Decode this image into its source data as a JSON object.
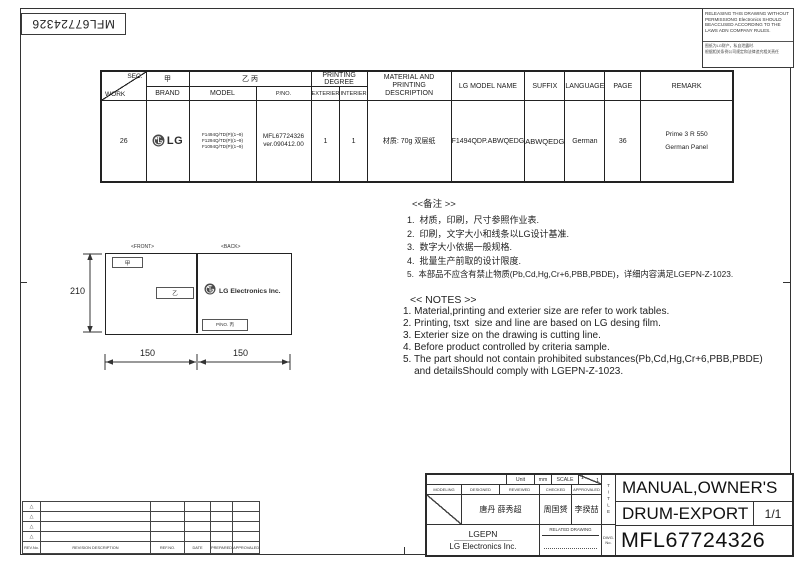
{
  "sheet": {
    "barcode_text": "MFL67724326",
    "notice": {
      "english": "RELEASING THIS DRAWING WITHOUT PERMISSIONG Electronics SHOULD BEACCUSED ACCORDING TO THE LAWS ADN COMPANY RULES.",
      "chinese_line1": "图纸为LG财产，私自泄露时.",
      "chinese_line2": "根据相关条例公司规定和法律追究相关责任"
    }
  },
  "spec_table": {
    "diag_top": "SEC.",
    "diag_bottom": "WORK",
    "col_brand_cn": "甲",
    "col_model_cn": "乙 丙",
    "headers": {
      "brand": "BRAND",
      "model": "MODEL",
      "pno": "P/NO.",
      "printing_degree": "PRINTING DEGREE",
      "exterier": "EXTERIER",
      "interier": "INTERIER",
      "material": "MATERIAL AND PRINTING DESCRIPTION",
      "lg_model_name": "LG MODEL NAME",
      "suffix": "SUFFIX",
      "language": "LANGUAGE",
      "page": "PAGE",
      "remark": "REMARK"
    },
    "row": {
      "work": "26",
      "brand_text": "LG",
      "models": [
        "F1494Q/TD(P)(1~9)",
        "F1294Q/TD(P)(1~9)",
        "F1094Q/TD(P)(1~9)"
      ],
      "pno_line1": "MFL67724326",
      "pno_line2": "ver.090412.00",
      "exterier": "1",
      "interier": "1",
      "material": "材质: 70g 双层纸",
      "lg_model_name": "F1494QDP.ABWQEDG",
      "suffix": "ABWQEDG",
      "language": "German",
      "page": "36",
      "remark_line1": "Prime 3  R 550",
      "remark_line2": "German Panel"
    }
  },
  "drawing": {
    "front_label": "<FRONT>",
    "back_label": "<BACK>",
    "front_box1": "甲",
    "front_box2": "乙",
    "back_logo_text": "LG Electronics Inc.",
    "back_pno_label": "P/NO. 丙",
    "dim_height": "210",
    "dim_width_left": "150",
    "dim_width_right": "150"
  },
  "notes_cn": {
    "title": "<<备注 >>",
    "items": [
      "1.  材质，印刷，尺寸参照作业表.",
      "2.  印刷，文字大小和线条以LG设计基准.",
      "3.  数字大小依据一般规格.",
      "4.  批量生产前取的设计限度.",
      "5.  本部品不应含有禁止物质(Pb,Cd,Hg,Cr+6,PBB,PBDE)，详细内容满足LGEPN-Z-1023."
    ]
  },
  "notes_en": {
    "title": "<< NOTES >>",
    "items": [
      "1. Material,printing and exterier size are refer to work tables.",
      "2. Printing, tsxt  size and line are based on LG desing film.",
      "3. Exterier size on the drawing is cutting line.",
      "4. Before product controlled by criteria sample.",
      "5. The part should not contain prohibited substances(Pb,Cd,Hg,Cr+6,PBB,PBDE)",
      "    and detailsShould comply with LGEPN-Z-1023."
    ]
  },
  "revision_table": {
    "marker": "△",
    "headers": {
      "rev_no": "REV.No.",
      "description": "REVISION DESCRIPTION",
      "ref_no": "REF.NO.",
      "date": "DATE",
      "prepared": "PREPARED",
      "approvaled": "APPROVALED"
    }
  },
  "title_block": {
    "unit_label": "Unit",
    "unit_value": "mm",
    "scale_label": "SCALE",
    "scale_num": "1",
    "scale_den": "1",
    "modeling_label": "MODELING",
    "designed_label": "DESIGNED",
    "reviewed_label": "REVIEWED",
    "checked_label": "CHECKED",
    "approvaled_label": "APPROVALED",
    "designed_name": "唐丹 薛秀超",
    "checked_name": "周国赟",
    "approvaled_name": "李揆喆",
    "company_short": "LGEPN",
    "company_full": "LG Electronics Inc.",
    "related_drawing_label": "RELATED DRAWING",
    "title_vertical": "TITLE",
    "dwg_label_line1": "DWG.",
    "dwg_label_line2": "No.",
    "title_line1": "MANUAL,OWNER'S",
    "title_line2": "DRUM-EXPORT",
    "sheet_no": "1/1",
    "dwg_no": "MFL67724326"
  },
  "colors": {
    "line": "#333333",
    "logo": "#4a4a4a"
  }
}
